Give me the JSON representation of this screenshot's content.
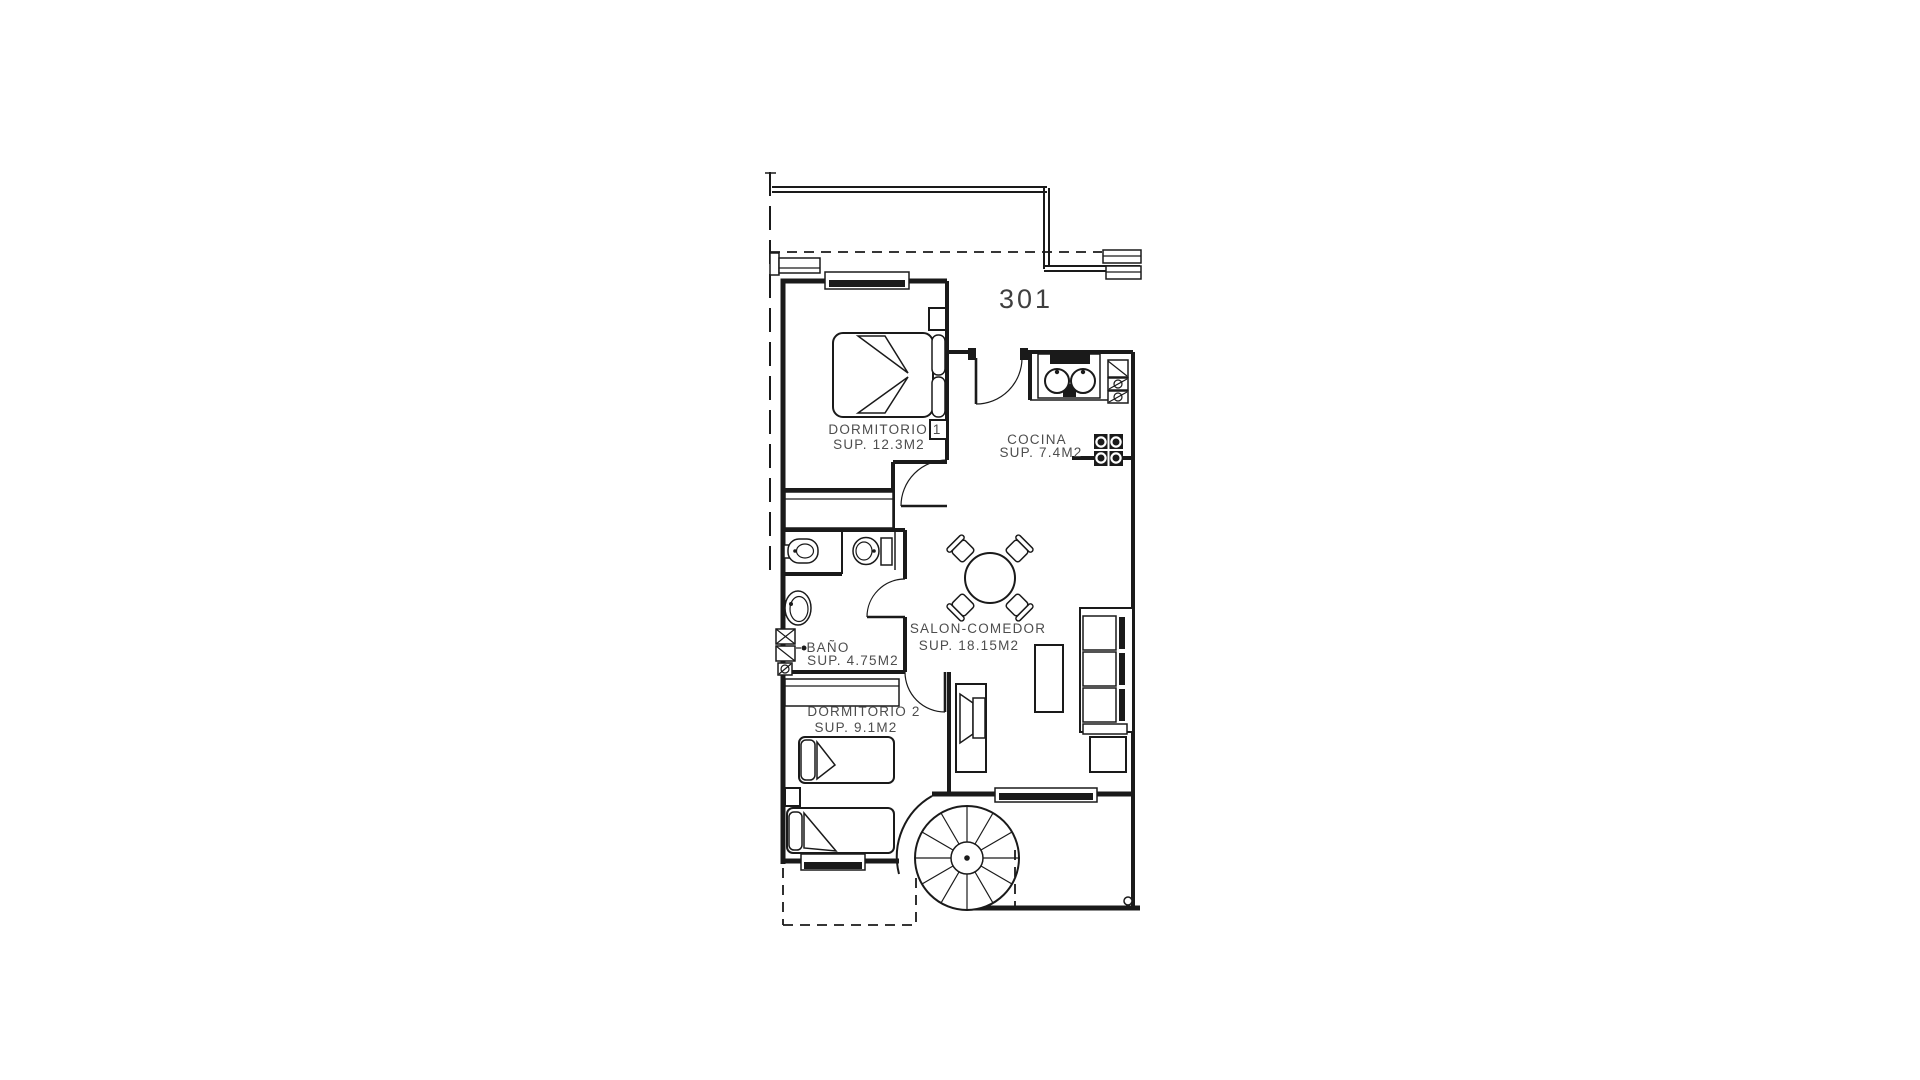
{
  "page": {
    "background": "#ffffff"
  },
  "plan": {
    "unit_label": "301",
    "colors": {
      "line": "#1a1a1a",
      "text": "#4d4d4d"
    },
    "rooms": [
      {
        "name": "DORMITORIO 1",
        "area": "SUP. 12.3M2"
      },
      {
        "name": "COCINA",
        "area": "SUP. 7.4M2"
      },
      {
        "name": "SALON-COMEDOR",
        "area": "SUP. 18.15M2"
      },
      {
        "name": "BAÑO",
        "area": "SUP. 4.75M2"
      },
      {
        "name": "DORMITORIO 2",
        "area": "SUP. 9.1M2"
      }
    ]
  }
}
